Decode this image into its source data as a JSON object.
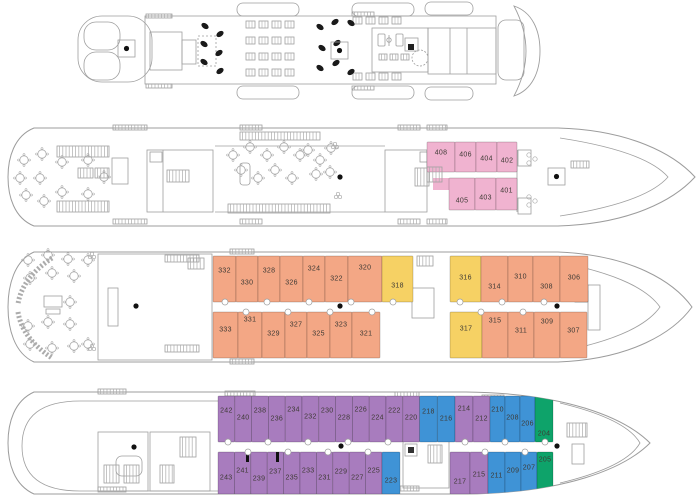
{
  "colors": {
    "pink": "#F0B3D0",
    "orange": "#F3A785",
    "yellow": "#F6D164",
    "purple": "#A87CBE",
    "blue": "#3F93D6",
    "green": "#0EA36A"
  },
  "decks": [
    {
      "rows": {
        "top": [],
        "bottom": []
      }
    },
    {
      "rows": {
        "top": [
          {
            "number": "408",
            "category": "pink"
          },
          {
            "number": "406",
            "category": "pink"
          },
          {
            "number": "404",
            "category": "pink"
          },
          {
            "number": "402",
            "category": "pink"
          }
        ],
        "bottom": [
          {
            "number": "405",
            "category": "pink"
          },
          {
            "number": "403",
            "category": "pink"
          },
          {
            "number": "401",
            "category": "pink"
          }
        ]
      }
    },
    {
      "rows": {
        "top": [
          {
            "number": "332",
            "category": "orange"
          },
          {
            "number": "330",
            "category": "orange"
          },
          {
            "number": "328",
            "category": "orange"
          },
          {
            "number": "326",
            "category": "orange"
          },
          {
            "number": "324",
            "category": "orange"
          },
          {
            "number": "322",
            "category": "orange"
          },
          {
            "number": "320",
            "category": "orange"
          },
          {
            "number": "318",
            "category": "yellow"
          },
          {
            "number": "316",
            "category": "yellow"
          },
          {
            "number": "314",
            "category": "orange"
          },
          {
            "number": "310",
            "category": "orange"
          },
          {
            "number": "308",
            "category": "orange"
          },
          {
            "number": "306",
            "category": "orange"
          }
        ],
        "bottom": [
          {
            "number": "333",
            "category": "orange"
          },
          {
            "number": "331",
            "category": "orange"
          },
          {
            "number": "329",
            "category": "orange"
          },
          {
            "number": "327",
            "category": "orange"
          },
          {
            "number": "325",
            "category": "orange"
          },
          {
            "number": "323",
            "category": "orange"
          },
          {
            "number": "321",
            "category": "orange"
          },
          {
            "number": "317",
            "category": "yellow"
          },
          {
            "number": "315",
            "category": "orange"
          },
          {
            "number": "311",
            "category": "orange"
          },
          {
            "number": "309",
            "category": "orange"
          },
          {
            "number": "307",
            "category": "orange"
          }
        ]
      }
    },
    {
      "rows": {
        "top": [
          {
            "number": "242",
            "category": "purple"
          },
          {
            "number": "240",
            "category": "purple"
          },
          {
            "number": "238",
            "category": "purple"
          },
          {
            "number": "236",
            "category": "purple"
          },
          {
            "number": "234",
            "category": "purple"
          },
          {
            "number": "232",
            "category": "purple"
          },
          {
            "number": "230",
            "category": "purple"
          },
          {
            "number": "228",
            "category": "purple"
          },
          {
            "number": "226",
            "category": "purple"
          },
          {
            "number": "224",
            "category": "purple"
          },
          {
            "number": "222",
            "category": "purple"
          },
          {
            "number": "220",
            "category": "purple"
          },
          {
            "number": "218",
            "category": "blue"
          },
          {
            "number": "216",
            "category": "blue"
          },
          {
            "number": "214",
            "category": "purple"
          },
          {
            "number": "212",
            "category": "purple"
          },
          {
            "number": "210",
            "category": "blue"
          },
          {
            "number": "208",
            "category": "blue"
          },
          {
            "number": "206",
            "category": "blue"
          },
          {
            "number": "204",
            "category": "green"
          }
        ],
        "bottom": [
          {
            "number": "243",
            "category": "purple"
          },
          {
            "number": "241",
            "category": "purple"
          },
          {
            "number": "239",
            "category": "purple"
          },
          {
            "number": "237",
            "category": "purple"
          },
          {
            "number": "235",
            "category": "purple"
          },
          {
            "number": "233",
            "category": "purple"
          },
          {
            "number": "231",
            "category": "purple"
          },
          {
            "number": "229",
            "category": "purple"
          },
          {
            "number": "227",
            "category": "purple"
          },
          {
            "number": "225",
            "category": "purple"
          },
          {
            "number": "223",
            "category": "blue"
          },
          {
            "number": "217",
            "category": "purple"
          },
          {
            "number": "215",
            "category": "purple"
          },
          {
            "number": "211",
            "category": "blue"
          },
          {
            "number": "209",
            "category": "blue"
          },
          {
            "number": "207",
            "category": "blue"
          },
          {
            "number": "205",
            "category": "green"
          }
        ]
      }
    }
  ]
}
